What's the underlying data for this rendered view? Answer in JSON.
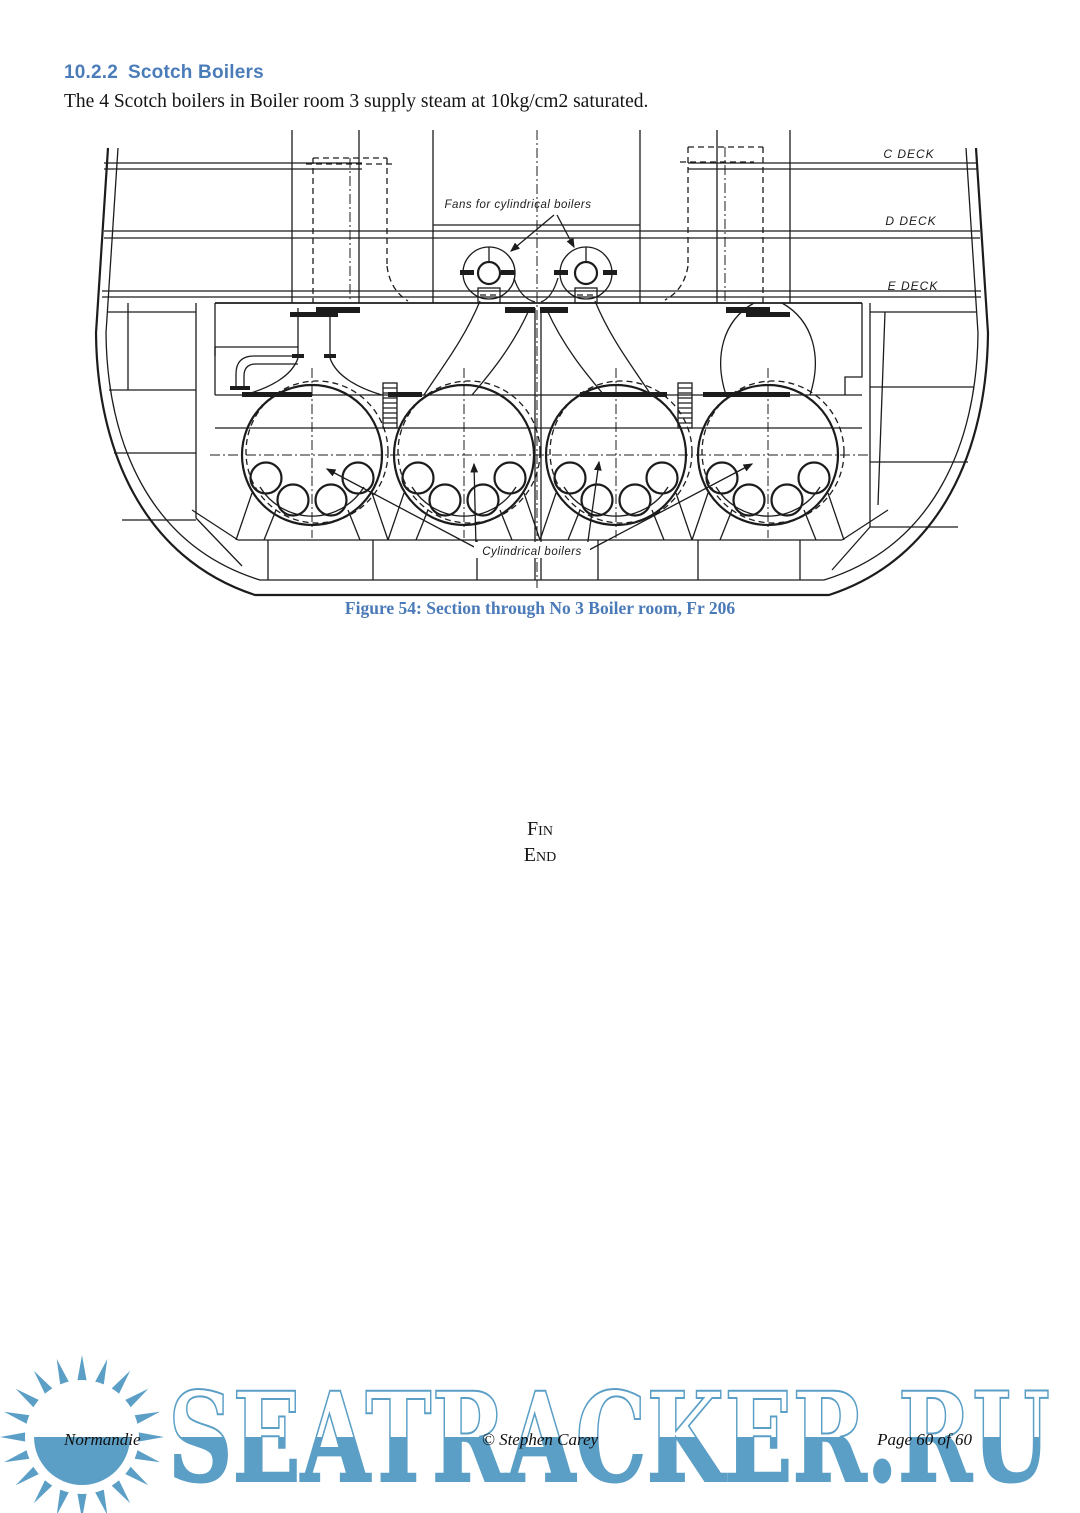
{
  "page": {
    "heading": {
      "number": "10.2.2",
      "title": "Scotch Boilers"
    },
    "body_text": "The 4 Scotch boilers in Boiler room 3 supply steam at 10kg/cm2 saturated.",
    "figure": {
      "caption": "Figure 54: Section through No 3 Boiler room, Fr 206",
      "labels": {
        "deck_c": "C DECK",
        "deck_d": "D DECK",
        "deck_e": "E DECK",
        "fans": "Fans for cylindrical boilers",
        "boilers": "Cylindrical boilers"
      }
    },
    "closing": {
      "fin": "Fin",
      "end": "End"
    },
    "footer": {
      "left": "Normandie",
      "center": "© Stephen Carey",
      "right": "Page 60 of 60"
    },
    "watermark": {
      "text": "SEATRACKER.RU",
      "color": "#5b9fc6"
    },
    "colors": {
      "heading_blue": "#4b7cba",
      "caption_blue": "#4a7ab8",
      "ink": "#1c1c1c"
    }
  }
}
